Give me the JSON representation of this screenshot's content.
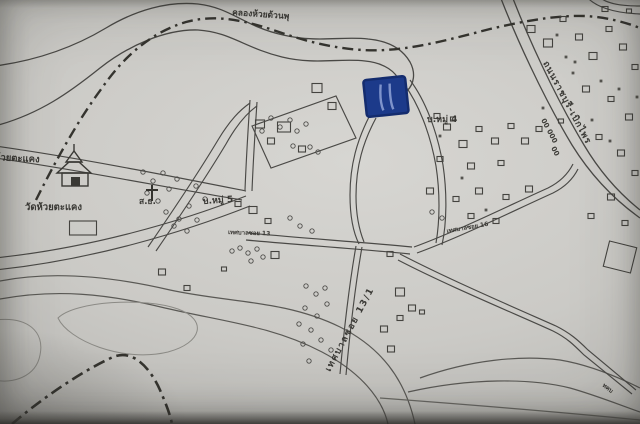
{
  "map": {
    "description": "Photograph of a printed hand-drawn Thai locality map with roads, canal boundary lines, village clusters and a blue pen highlight",
    "labels": {
      "canal_top": "คลองห้วยด้วนพุ",
      "road_left_partial": "ห้วยตะแคง",
      "temple": "วัดห้วยตะแคง",
      "school_abbr": "ส.ธ.",
      "village_moo5": "บ.หมู่ 5",
      "village_moo4": "บ.หมู่ 4",
      "soi_13": "เทศบาลซอย 13",
      "soi_16": "เทศบาลซอย 16",
      "soi_13_1": "เทศบาลซอย 13/1",
      "highway": "ถนนราชบุรี-เบิกไพร",
      "km_post_top": "00 000",
      "km_post_bottom": "00",
      "road_bottom_right": "ทคบ"
    },
    "colors": {
      "paper": "#c9c8c4",
      "ink": "#4a4946",
      "boundary_ink": "#35342f",
      "water_light": "#8b8a85",
      "marker_blue": "#1c3a8a",
      "marker_blue_dark": "#142c6e",
      "marker_streak": "#8fa3d6"
    },
    "symbols": {
      "temple_icon": "wat (temple) pictogram",
      "cross_icon": "church/mission cross pictogram",
      "highlight_marker": "blue pen highlighted plot",
      "building_square": "small square = house/building",
      "tree_circle": "small circle = tree/orchard",
      "dashdot_line": "boundary / canal line"
    },
    "buildings": [
      [
        317,
        88,
        10,
        9
      ],
      [
        332,
        106,
        8,
        7
      ],
      [
        260,
        124,
        9,
        8
      ],
      [
        284,
        127,
        13,
        10
      ],
      [
        271,
        141,
        7,
        6
      ],
      [
        302,
        149,
        7,
        6
      ],
      [
        238,
        204,
        6,
        5
      ],
      [
        253,
        210,
        8,
        7
      ],
      [
        268,
        221,
        6,
        5
      ],
      [
        447,
        127,
        7,
        6
      ],
      [
        463,
        144,
        8,
        7
      ],
      [
        479,
        129,
        6,
        5
      ],
      [
        495,
        141,
        7,
        6
      ],
      [
        511,
        126,
        6,
        5
      ],
      [
        525,
        141,
        7,
        6
      ],
      [
        539,
        129,
        6,
        5
      ],
      [
        440,
        159,
        6,
        5
      ],
      [
        471,
        166,
        7,
        6
      ],
      [
        501,
        163,
        6,
        5
      ],
      [
        453,
        119,
        5,
        4
      ],
      [
        430,
        191,
        7,
        6
      ],
      [
        456,
        199,
        6,
        5
      ],
      [
        479,
        191,
        7,
        6
      ],
      [
        506,
        197,
        6,
        5
      ],
      [
        529,
        189,
        7,
        6
      ],
      [
        471,
        216,
        6,
        5
      ],
      [
        496,
        221,
        6,
        5
      ],
      [
        437,
        116,
        6,
        5
      ],
      [
        531,
        29,
        8,
        7
      ],
      [
        548,
        43,
        9,
        8
      ],
      [
        563,
        19,
        6,
        5
      ],
      [
        579,
        37,
        7,
        6
      ],
      [
        593,
        56,
        8,
        7
      ],
      [
        609,
        29,
        6,
        5
      ],
      [
        623,
        47,
        7,
        6
      ],
      [
        635,
        67,
        6,
        5
      ],
      [
        586,
        89,
        7,
        6
      ],
      [
        611,
        99,
        6,
        5
      ],
      [
        629,
        117,
        7,
        6
      ],
      [
        599,
        137,
        6,
        5
      ],
      [
        621,
        153,
        7,
        6
      ],
      [
        635,
        173,
        6,
        5
      ],
      [
        561,
        121,
        5,
        4
      ],
      [
        605,
        9,
        6,
        5
      ],
      [
        629,
        11,
        5,
        4
      ],
      [
        611,
        197,
        7,
        6
      ],
      [
        591,
        216,
        6,
        5
      ],
      [
        625,
        223,
        6,
        5
      ],
      [
        620,
        257,
        28,
        26,
        14
      ],
      [
        400,
        292,
        9,
        8
      ],
      [
        412,
        308,
        7,
        6
      ],
      [
        400,
        318,
        6,
        5
      ],
      [
        422,
        312,
        5,
        4
      ],
      [
        384,
        329,
        7,
        6
      ],
      [
        391,
        349,
        7,
        6
      ],
      [
        275,
        255,
        8,
        7
      ],
      [
        162,
        272,
        7,
        6
      ],
      [
        187,
        288,
        6,
        5
      ],
      [
        224,
        269,
        5,
        4
      ],
      [
        83,
        228,
        27,
        14
      ],
      [
        390,
        254,
        6,
        5
      ]
    ],
    "trees": [
      [
        143,
        172
      ],
      [
        153,
        181
      ],
      [
        163,
        173
      ],
      [
        147,
        193
      ],
      [
        158,
        201
      ],
      [
        169,
        189
      ],
      [
        177,
        179
      ],
      [
        166,
        212
      ],
      [
        179,
        219
      ],
      [
        189,
        206
      ],
      [
        174,
        226
      ],
      [
        187,
        231
      ],
      [
        197,
        220
      ],
      [
        205,
        199
      ],
      [
        196,
        186
      ],
      [
        271,
        118
      ],
      [
        280,
        127
      ],
      [
        290,
        120
      ],
      [
        297,
        131
      ],
      [
        306,
        124
      ],
      [
        262,
        131
      ],
      [
        293,
        146
      ],
      [
        310,
        147
      ],
      [
        318,
        152
      ],
      [
        240,
        248
      ],
      [
        248,
        253
      ],
      [
        257,
        249
      ],
      [
        263,
        257
      ],
      [
        251,
        261
      ],
      [
        232,
        251
      ],
      [
        306,
        286
      ],
      [
        316,
        294
      ],
      [
        305,
        308
      ],
      [
        317,
        316
      ],
      [
        327,
        304
      ],
      [
        311,
        330
      ],
      [
        321,
        340
      ],
      [
        331,
        350
      ],
      [
        303,
        344
      ],
      [
        309,
        361
      ],
      [
        299,
        324
      ],
      [
        325,
        288
      ],
      [
        432,
        212
      ],
      [
        442,
        218
      ],
      [
        290,
        218
      ],
      [
        300,
        226
      ],
      [
        312,
        231
      ]
    ],
    "dots": [
      [
        557,
        35
      ],
      [
        573,
        73
      ],
      [
        601,
        81
      ],
      [
        619,
        89
      ],
      [
        637,
        97
      ],
      [
        566,
        57
      ],
      [
        592,
        120
      ],
      [
        610,
        141
      ],
      [
        575,
        62
      ],
      [
        543,
        108
      ],
      [
        440,
        136
      ],
      [
        462,
        178
      ],
      [
        486,
        210
      ]
    ]
  }
}
